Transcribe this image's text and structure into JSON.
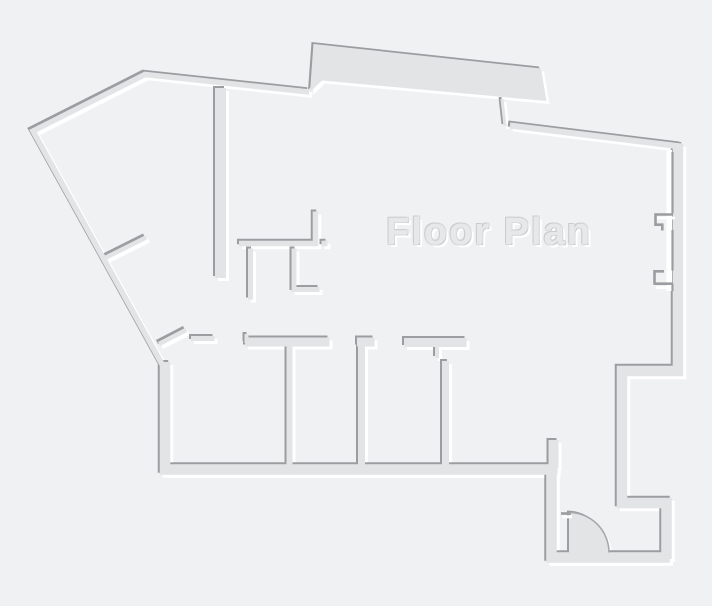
{
  "title": {
    "label": "Floor Plan"
  },
  "colors": {
    "background": "#f0f1f2",
    "wall": "#e2e4e5",
    "wall-shadow": "#9b9da0",
    "wall-highlight": "#ffffff",
    "title-fill": "#e6e8e9",
    "title-outline": "#c9cbcd",
    "title-outline-light": "#d8dadc",
    "door-arc": "#a6a8ab"
  }
}
